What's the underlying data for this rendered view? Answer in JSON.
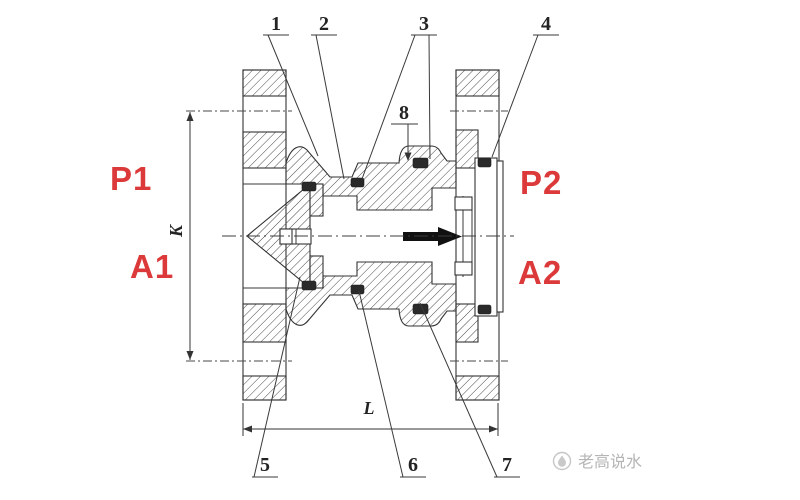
{
  "page": {
    "background": "#ffffff"
  },
  "drawing": {
    "type": "technical-section-drawing",
    "subject": "flanged check valve cutaway, flow left to right",
    "ports": {
      "p1": "P1",
      "a1": "A1",
      "p2": "P2",
      "a2": "A2",
      "label_color": "#dc3a3a"
    },
    "callouts": {
      "c1": "1",
      "c2": "2",
      "c3": "3",
      "c4": "4",
      "c5": "5",
      "c6": "6",
      "c7": "7",
      "c8": "8"
    },
    "dimensions": {
      "vertical": "K",
      "horizontal": "L"
    },
    "flow_arrow": {
      "direction": "right",
      "color": "#111111"
    },
    "watermark": {
      "logo": "water-drop-logo",
      "text": "老高说水",
      "color": "#b5b5b5"
    }
  }
}
